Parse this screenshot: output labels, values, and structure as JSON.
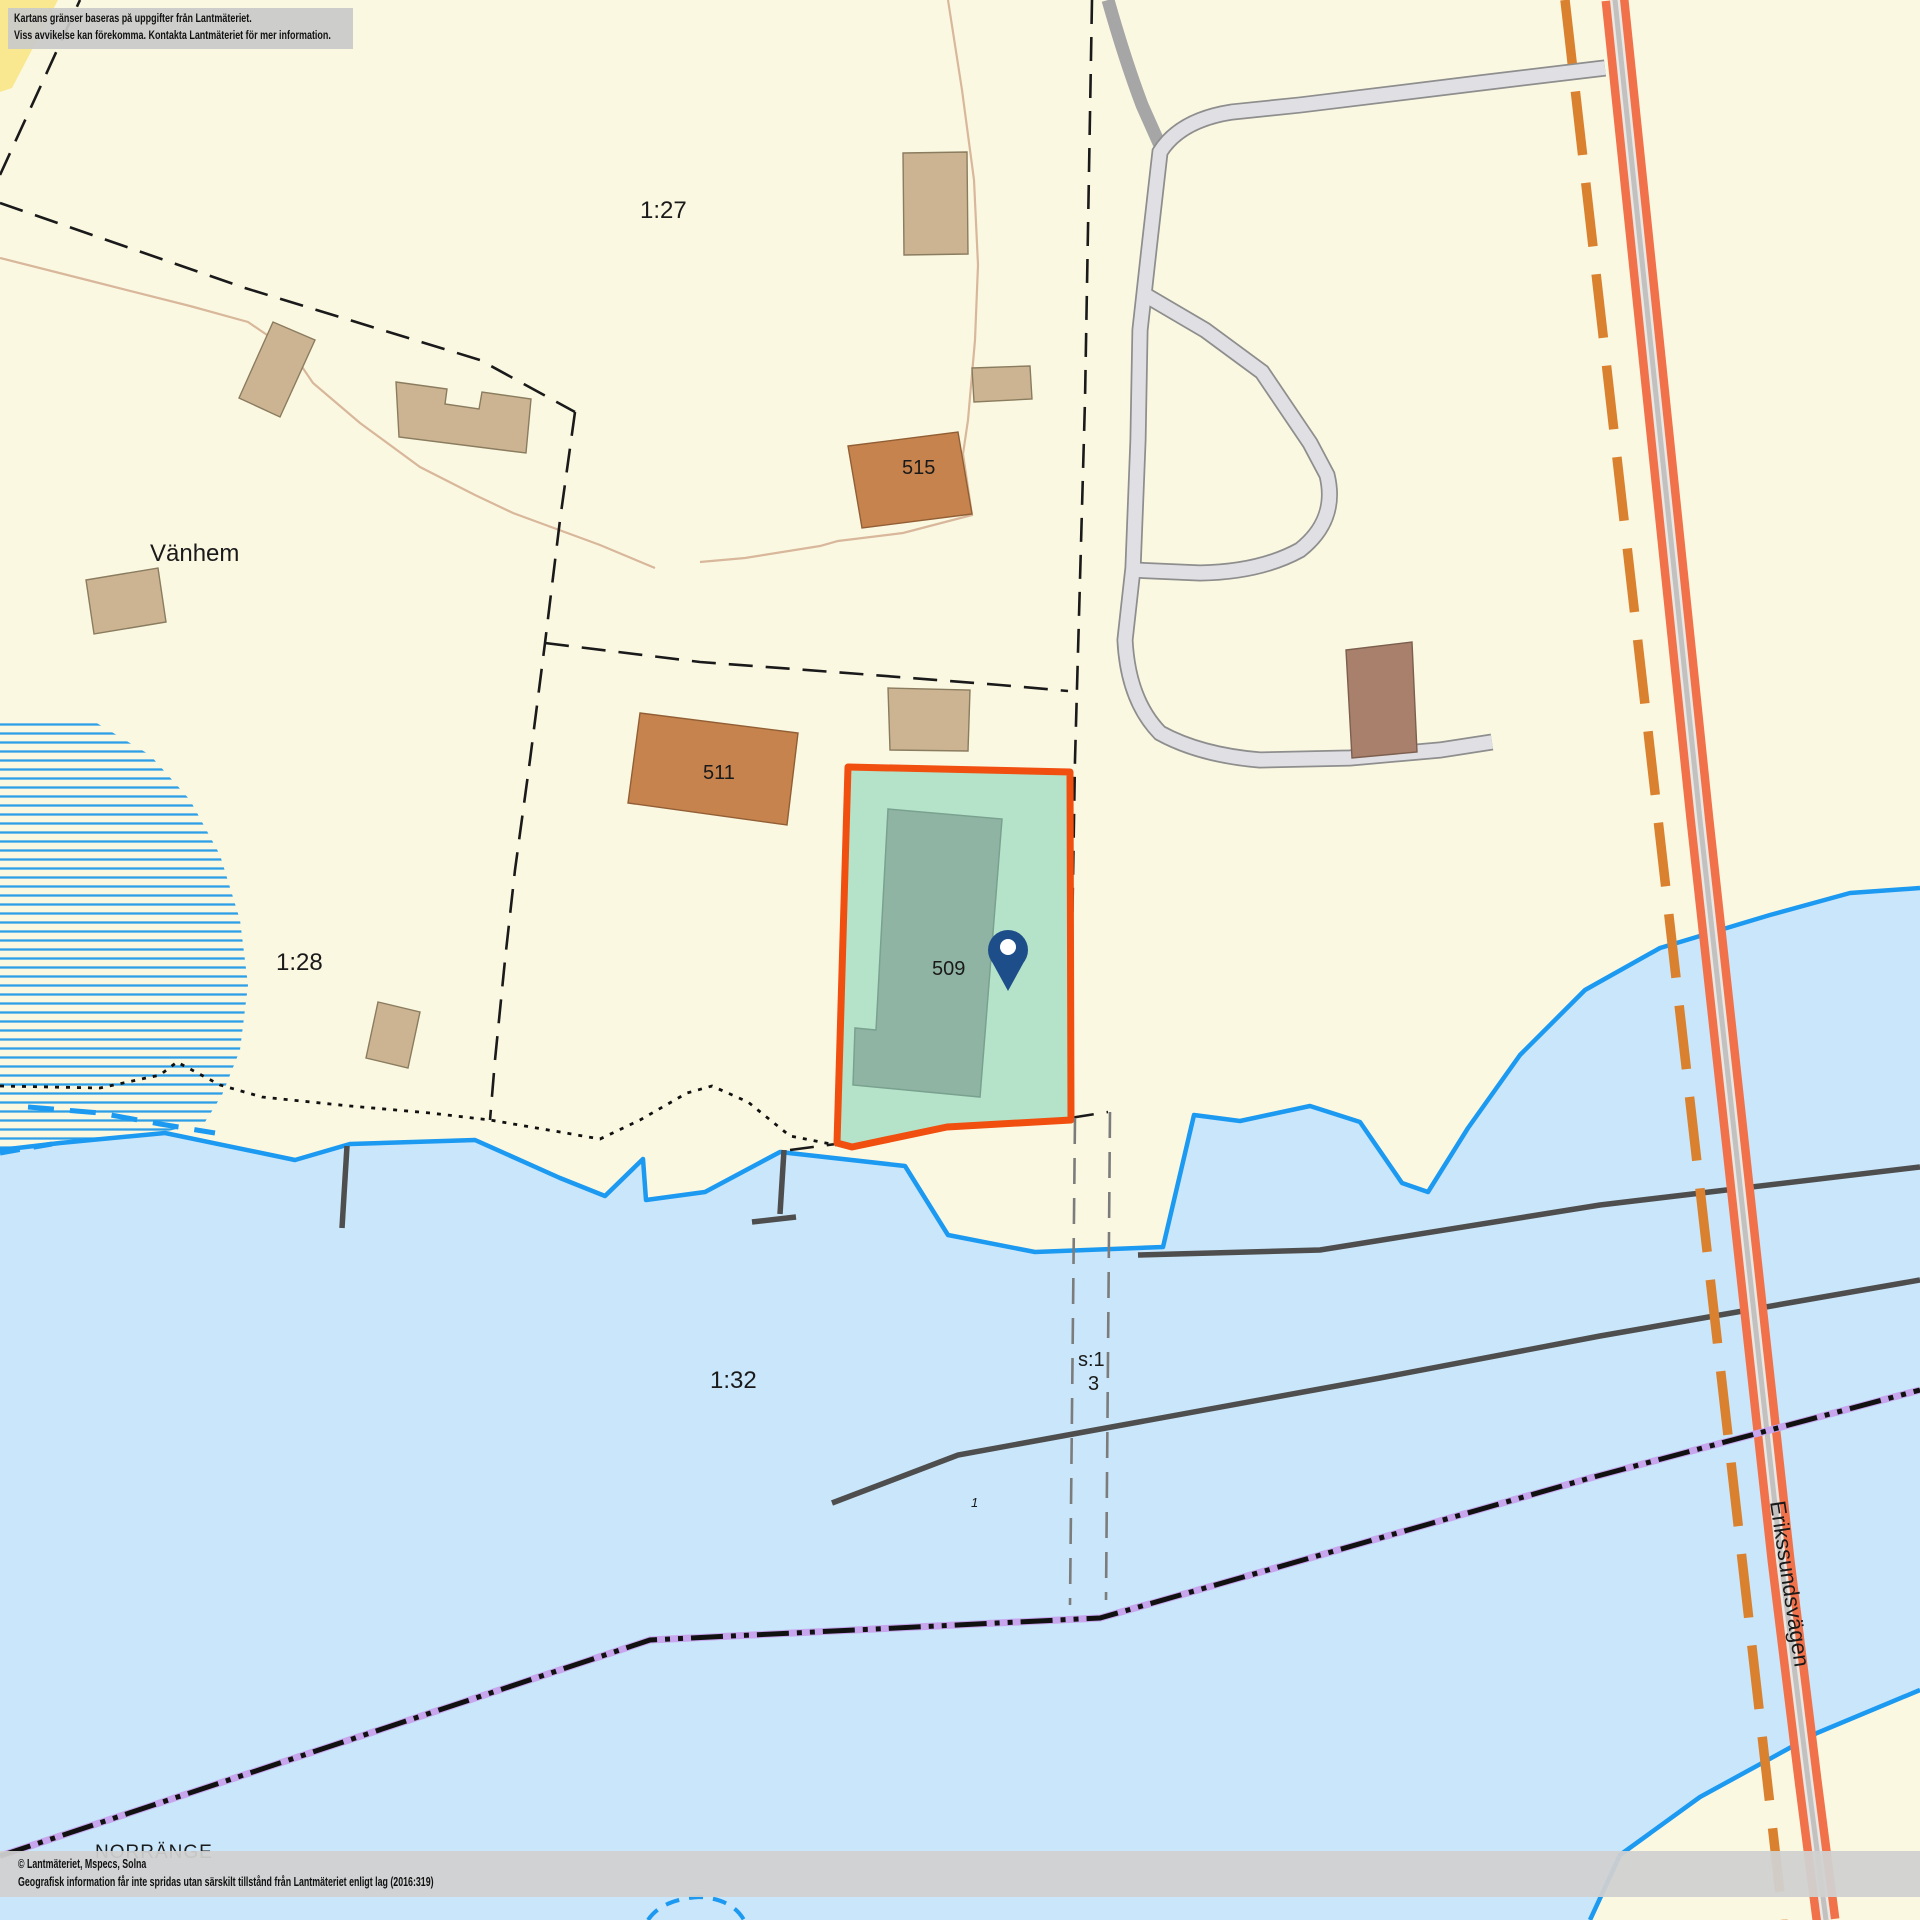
{
  "map_overlay": {
    "disclaimer_line1": "Kartans gränser baseras på uppgifter från Lantmäteriet.",
    "disclaimer_line2": "Viss avvikelse kan förekomma. Kontakta Lantmäteriet för mer information.",
    "attribution_line1": "© Lantmäteriet, Mspecs, Solna",
    "attribution_line2": "Geografisk information får inte spridas utan särskilt tillstånd från Lantmäteriet enligt lag (2016:319)"
  },
  "labels": {
    "parcel_1_27": "1:27",
    "parcel_1_28": "1:28",
    "parcel_1_32": "1:32",
    "parcel_s1": "s:1",
    "parcel_s1_sub": "3",
    "building_515": "515",
    "building_511": "511",
    "building_509": "509",
    "place_vanhem": "Vänhem",
    "place_norrange": "NORRÄNGE",
    "road_erikssundsvagen": "Erikssundsvägen",
    "water_marker_1": "1"
  },
  "marker": {
    "name": "location-pin",
    "color": "#1D4E89"
  },
  "highlight_parcel": {
    "number": "509",
    "fill": "#B5E3C9",
    "stroke": "#F04F10"
  },
  "colors": {
    "land": "#FBF8E2",
    "bright_corner": "#F9E88F",
    "water": "#C9E6FA",
    "shoreline": "#1C99F0",
    "marsh_hatch": "#2D9FE6",
    "main_road": "#F1724A",
    "municipal_boundary": "#D9812F",
    "gray_road": "#E0DFE3",
    "building_tan": "#CCB493",
    "building_brown": "#C6834E",
    "building_mauve": "#A8806C",
    "building_on_parcel": "#8FB4A3",
    "power_line": "#4E4E4E",
    "purple_boundary": "#C7A6EE"
  }
}
